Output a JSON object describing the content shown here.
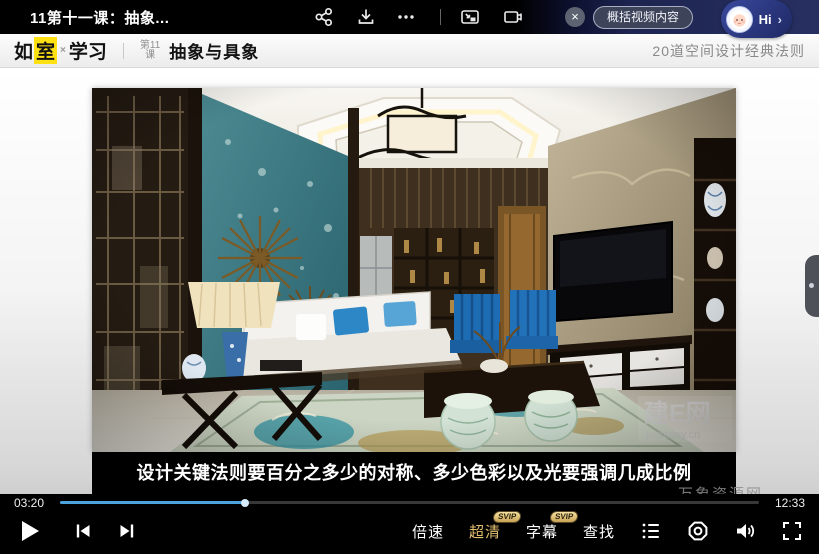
{
  "topbar": {
    "title": "11第十一课：抽象...",
    "summarize_label": "概括视频内容",
    "hi_label": "Hi",
    "hi_arrow": "›",
    "close_glyph": "×"
  },
  "header": {
    "logo_ru": "如",
    "logo_shi": "室",
    "logo_times": "×",
    "logo_study": "学习",
    "lesson_no_line1": "第11",
    "lesson_no_line2": "课",
    "lesson_title": "抽象与具象",
    "course_title": "20道空间设计经典法则"
  },
  "video": {
    "subtitle": "设计关键法则要百分之多少的对称、多少色彩以及光要强调几成比例",
    "photo_watermark": "建E网",
    "photo_watermark_sub": "justeasy.cn"
  },
  "player": {
    "current_time": "03:20",
    "total_time": "12:33",
    "progress_percent": 26.5,
    "speed_label": "倍速",
    "quality_label": "超清",
    "subtitle_label": "字幕",
    "find_label": "查找",
    "svip_badge": "SVIP"
  },
  "watermark": {
    "site_name": "万象资源网",
    "site_url": "https://www.wxzyw.cn"
  },
  "icons": {
    "topbar": [
      "share-icon",
      "download-icon",
      "more-icon",
      "pip-icon",
      "cast-icon",
      "close-icon"
    ],
    "player": [
      "play-icon",
      "previous-icon",
      "next-icon",
      "playlist-icon",
      "settings-icon",
      "volume-icon",
      "fullscreen-icon"
    ]
  },
  "colors": {
    "progress_blue": "#4aa3dc",
    "accent_gold": "#e2bf6e",
    "logo_yellow": "#ffe013",
    "navy_pill": "#27306b"
  }
}
